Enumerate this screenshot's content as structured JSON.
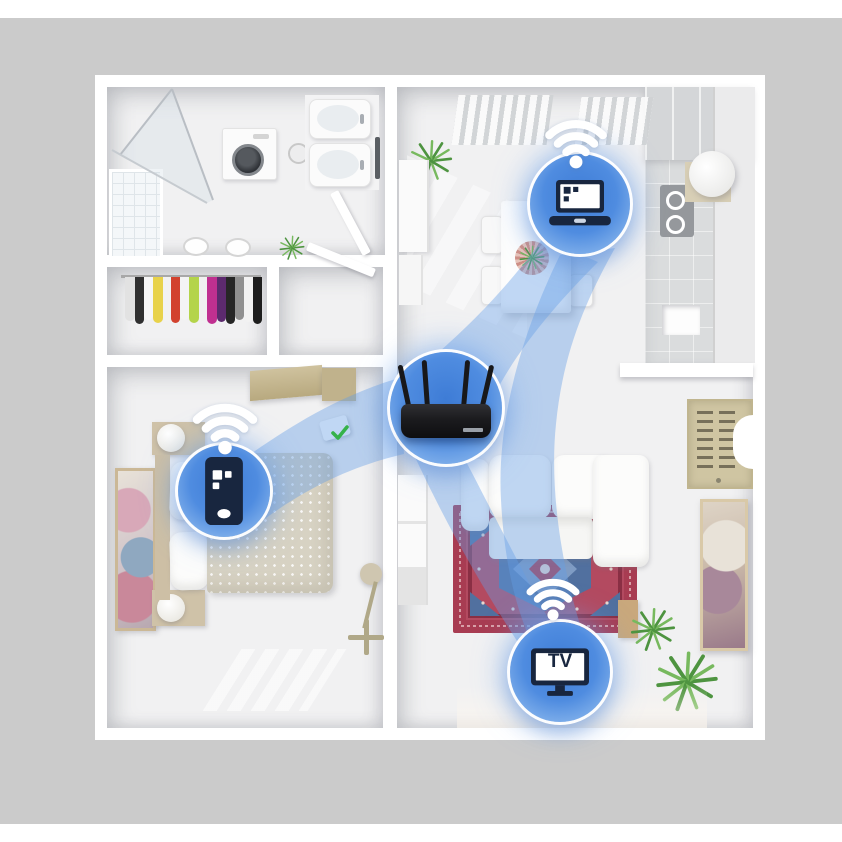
{
  "scene": {
    "type": "wifi-router-whole-home-coverage-illustration",
    "background_gray": "#cbcbcb",
    "wall_white": "#ffffff",
    "accent_blue": "#4e8cdf",
    "beam_blue": "rgba(100,158,229,0.40)",
    "glyph_navy": "#18263f",
    "circle_ring": "#ffffff",
    "check_green": "#35b24a"
  },
  "labels": {
    "tv": "TV"
  },
  "nodes": [
    {
      "id": "router",
      "icon": "wifi-router",
      "location": "center-of-floor-plan"
    },
    {
      "id": "laptop",
      "icon": "laptop-icon",
      "location": "kitchen-dining-room"
    },
    {
      "id": "smartphone",
      "icon": "smartphone-icon",
      "location": "bedroom"
    },
    {
      "id": "tv",
      "icon": "tv-icon",
      "location": "living-room"
    }
  ],
  "connections": [
    [
      "router",
      "laptop"
    ],
    [
      "router",
      "smartphone"
    ],
    [
      "router",
      "tv"
    ],
    [
      "laptop",
      "tv"
    ]
  ],
  "rooms": [
    "bathroom",
    "closet",
    "entry",
    "bedroom",
    "kitchen-dining",
    "living-room"
  ]
}
